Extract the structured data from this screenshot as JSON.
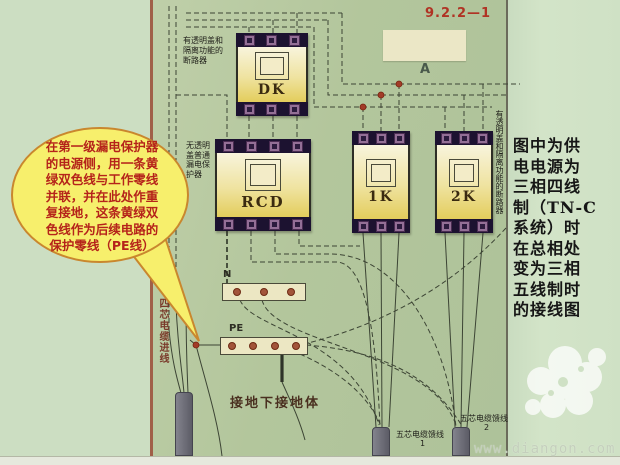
{
  "figure_label": "9.2.2—1",
  "annotation_a": "A",
  "speech_bubble": {
    "text": "在第一级漏电保护器\n的电源侧，用一条黄\n绿双色线与工作零线\n并联，并在此处作重\n复接地，这条黄绿双\n色线作为后续电路的\n保护零线（PE线）",
    "fill_color": "#f7ef6c",
    "outline_color": "#c9872e",
    "text_color": "#b5231a"
  },
  "devices": {
    "dk": {
      "label": "DK",
      "desc": "有透明盖和\n隔离功能的\n断路器",
      "terminals": 3
    },
    "rcd": {
      "label": "RCD",
      "desc": "无透明盖普通漏电保护器",
      "terminals": 4
    },
    "k1": {
      "label": "1K",
      "terminals": 3
    },
    "k2": {
      "label": "2K",
      "terminals": 3
    },
    "right_breaker_desc": "有透明盖和隔离功能的断路器"
  },
  "buses": {
    "n_label": "N",
    "pe_label": "PE"
  },
  "ground_note": "接地下接地体",
  "cables": {
    "incoming_label": "四芯电缆进线",
    "feeder1": {
      "label": "五芯电缆馈线",
      "no": "1"
    },
    "feeder2": {
      "label": "五芯电缆馈线",
      "no": "2"
    }
  },
  "sidebar": {
    "text": "图中为供\n电电源为\n三相四线\n制（TN-C\n系统）时\n在总相处\n变为三相\n五线制时\n的接线图",
    "watermark": "www.diangon.com"
  },
  "colors": {
    "paper": "#b3c69c",
    "background": "#ccdec2",
    "accent_red": "#b02c1e",
    "device_body": "#efe3a0",
    "terminal": "#936f96",
    "wire": "#3c4434"
  }
}
